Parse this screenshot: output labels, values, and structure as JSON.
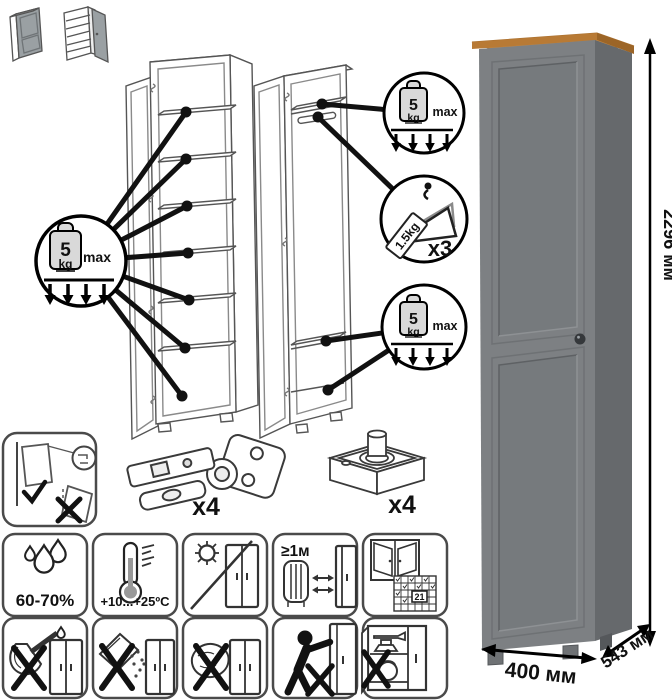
{
  "callouts": {
    "weight": {
      "value": "5",
      "unit": "kg",
      "max": "max"
    },
    "hanger": {
      "tag": "1.5kg",
      "count": "x3"
    }
  },
  "parts": {
    "hinge_count": "x4",
    "foot_count": "x4"
  },
  "care": {
    "humidity": "60-70%",
    "temperature": "+10...+25ºC",
    "heater_distance": "≥1м",
    "ventilation_day": "21"
  },
  "dimensions": {
    "height": "2296 мм",
    "width": "400 мм",
    "depth": "543 мм"
  },
  "product_colors": {
    "front": "#7d8083",
    "side": "#66696c",
    "top_wood": "#c88a43",
    "knob": "#35383b"
  },
  "icon_names": [
    "shelf-weight-limit-icon",
    "hanger-load-icon",
    "anchor-to-wall-icon",
    "hinge-part-icon",
    "foot-part-icon",
    "humidity-icon",
    "temperature-icon",
    "no-direct-sunlight-icon",
    "heater-distance-icon",
    "ventilation-icon",
    "no-sharp-tools-icon",
    "no-abrasive-powder-icon",
    "no-wet-cloth-icon",
    "do-not-drag-icon",
    "do-not-overload-icon"
  ]
}
